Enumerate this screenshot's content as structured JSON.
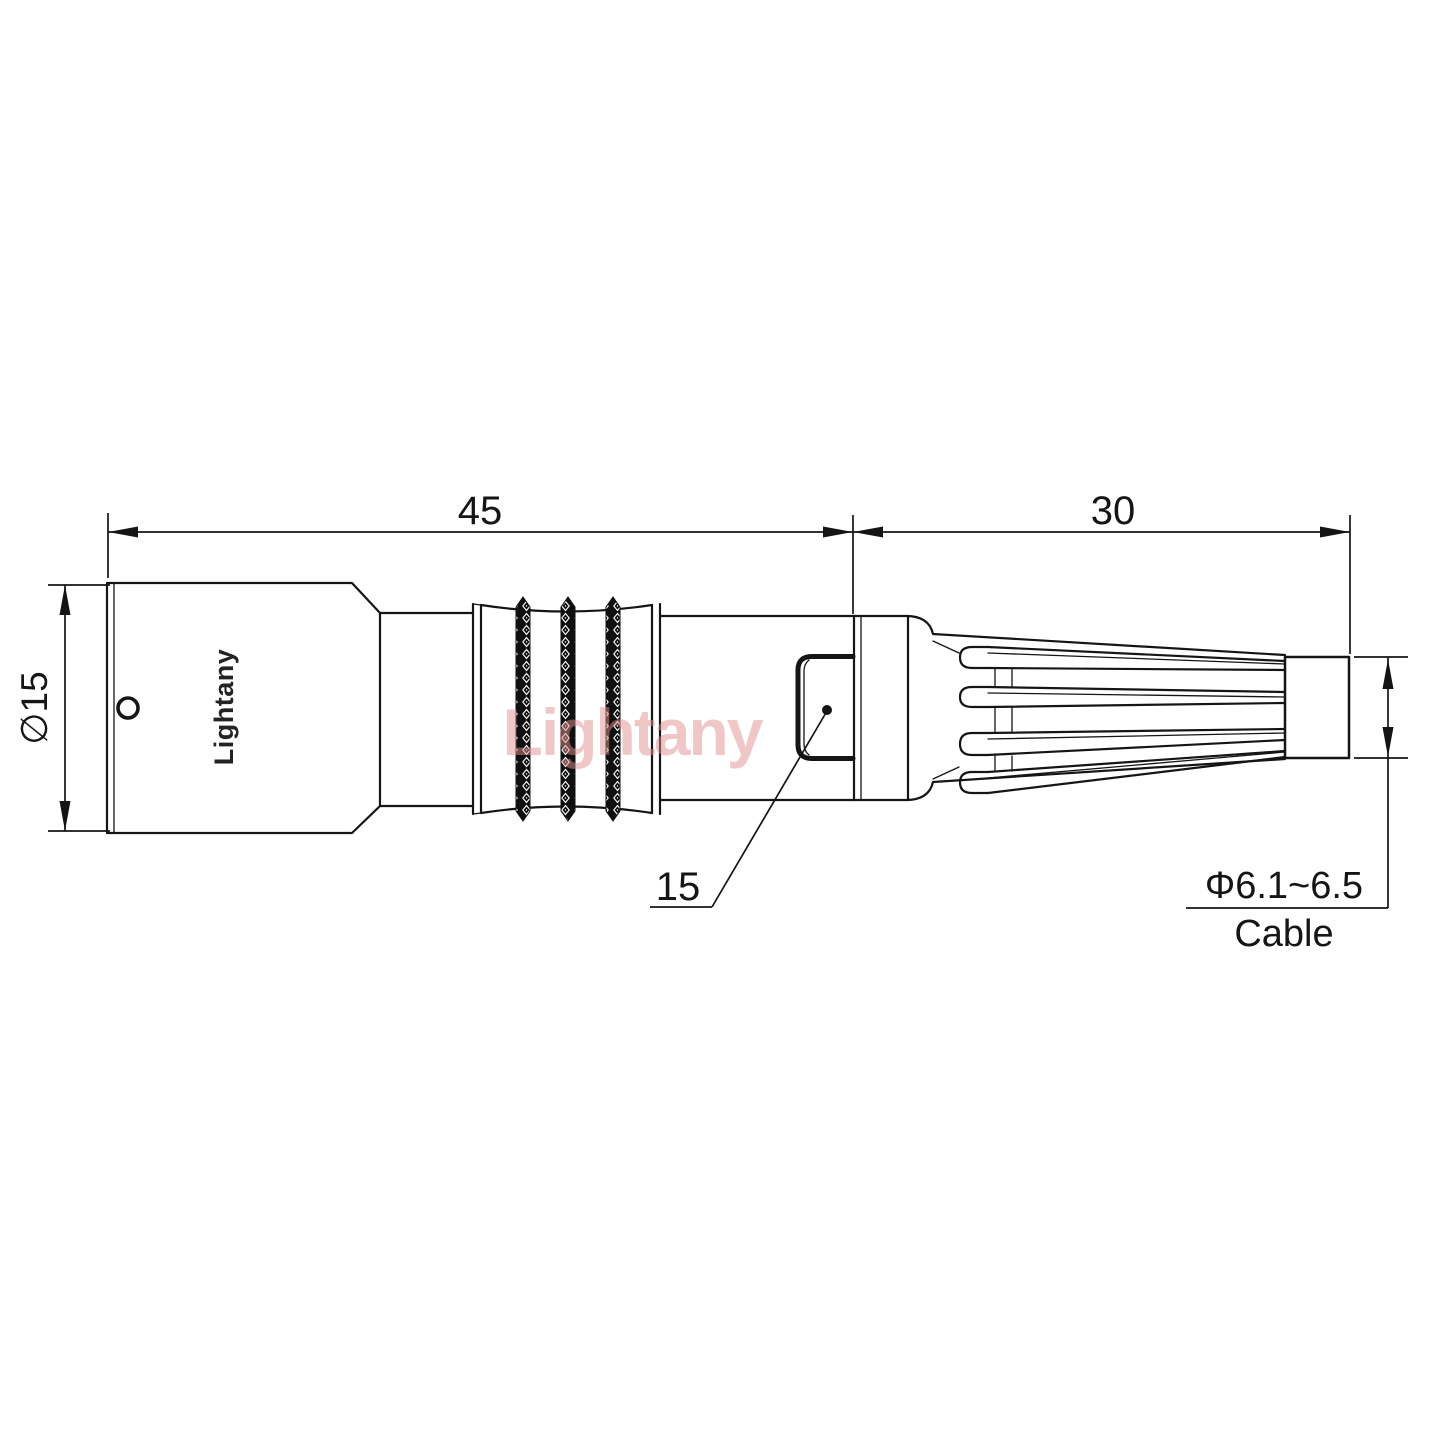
{
  "labels": {
    "dim_body_length": "45",
    "dim_strain_length": "30",
    "dim_body_diameter": "∅15",
    "dim_nut": "15",
    "dim_cable_diameter": "Φ6.1~6.5",
    "cable_word": "Cable"
  },
  "branding": {
    "body_logo": "Lightany",
    "watermark": "Lightany"
  },
  "colors": {
    "line": "#151515",
    "watermark_pink": "#df8f8f",
    "background": "#ffffff"
  }
}
